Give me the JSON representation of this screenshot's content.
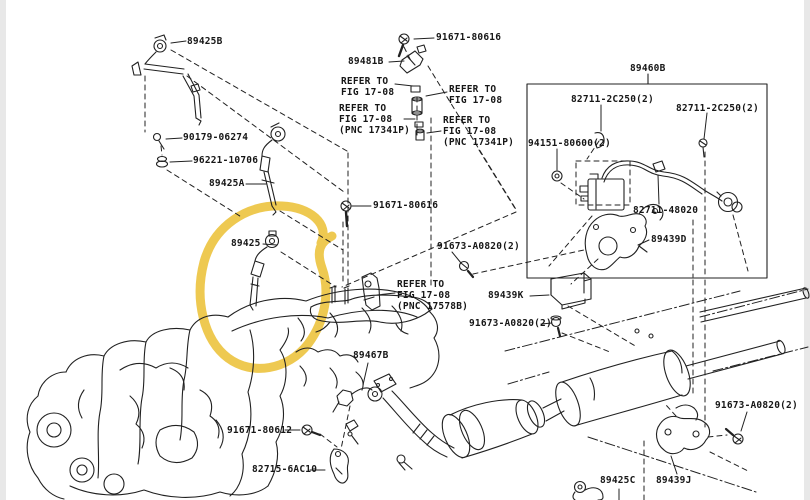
{
  "page": {
    "background": "#ffffff",
    "line_color": "#212121",
    "side_strip_color": "#e8e8e8",
    "highlight_color": "#ecc33e",
    "description": "Toyota parts catalog exploded diagram - oxygen sensors and exhaust, part 89425 circled in yellow"
  },
  "inset": {
    "box_label": "89460B"
  },
  "labels": [
    {
      "id": "p89425B",
      "text": "89425B"
    },
    {
      "id": "p90179",
      "text": "90179-06274"
    },
    {
      "id": "p96221",
      "text": "96221-10706"
    },
    {
      "id": "p89425A",
      "text": "89425A"
    },
    {
      "id": "p91671_top",
      "text": "91671-80616"
    },
    {
      "id": "p89481B",
      "text": "89481B"
    },
    {
      "id": "ref_left",
      "text": "REFER TO\nFIG 17-08"
    },
    {
      "id": "ref_right",
      "text": "REFER TO\nFIG 17-08"
    },
    {
      "id": "ref_pnc_left",
      "text": "REFER TO\nFIG 17-08\n(PNC 17341P)"
    },
    {
      "id": "ref_pnc_right",
      "text": "REFER TO\nFIG 17-08\n(PNC 17341P)"
    },
    {
      "id": "p89460B",
      "text": "89460B"
    },
    {
      "id": "p82711_a",
      "text": "82711-2C250(2)"
    },
    {
      "id": "p82711_b",
      "text": "82711-2C250(2)"
    },
    {
      "id": "p94151",
      "text": "94151-80600(2)"
    },
    {
      "id": "p82711_48020",
      "text": "82711-48020"
    },
    {
      "id": "p89439D",
      "text": "89439D"
    },
    {
      "id": "p89425",
      "text": "89425"
    },
    {
      "id": "p91671_mid",
      "text": "91671-80616"
    },
    {
      "id": "p91673_up",
      "text": "91673-A0820(2)"
    },
    {
      "id": "ref_17578",
      "text": "REFER TO\nFIG 17-08\n(PNC 17578B)"
    },
    {
      "id": "p89439K",
      "text": "89439K"
    },
    {
      "id": "p91673_low",
      "text": "91673-A0820(2)"
    },
    {
      "id": "p89467B",
      "text": "89467B"
    },
    {
      "id": "p91671_80612",
      "text": "91671-80612"
    },
    {
      "id": "p82715",
      "text": "82715-6AC10"
    },
    {
      "id": "p91673_br",
      "text": "91673-A0820(2)"
    },
    {
      "id": "p89425C",
      "text": "89425C"
    },
    {
      "id": "p89439J",
      "text": "89439J"
    }
  ]
}
